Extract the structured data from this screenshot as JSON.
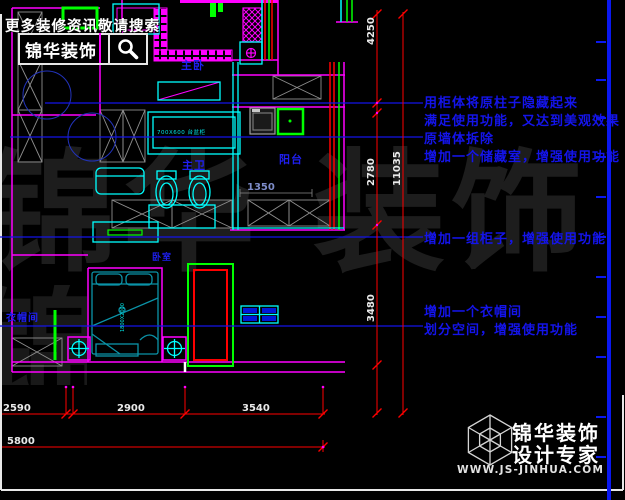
{
  "search_banner": {
    "tagline": "更多装修资讯敬请搜索",
    "brand": "锦华装饰"
  },
  "plan": {
    "room_labels": [
      {
        "text": "主卧"
      },
      {
        "text": "主卫"
      },
      {
        "text": "阳台"
      },
      {
        "text": "衣帽间"
      },
      {
        "text": "卧室"
      }
    ],
    "fixture_labels": [
      {
        "text": "700X600 台盆柜"
      },
      {
        "text": "1800X2000"
      }
    ],
    "inline_dimension": "1350"
  },
  "annotations": {
    "group1": [
      "用柜体将原柱子隐藏起来",
      "满足使用功能，又达到美观效果",
      "原墙体拆除",
      "增加一个储藏室，增强使用功能"
    ],
    "group2": [
      "增加一组柜子，增强使用功能"
    ],
    "group3": [
      "增加一个衣帽间",
      "划分空间，增强使用功能"
    ]
  },
  "dimensions": {
    "vertical": [
      "4250",
      "2780",
      "11035",
      "3480"
    ],
    "bottom_row1": [
      "2590",
      "2900",
      "3540"
    ],
    "bottom_row2": [
      "5800"
    ]
  },
  "watermark": {
    "text": "锦华 装饰"
  },
  "footer": {
    "brand": "锦华装饰",
    "tagline": "设计专家",
    "url": "WWW.JS-JINHUA.COM"
  },
  "colors": {
    "wall": "#ff00ff",
    "fixture": "#00ffff",
    "accent_green": "#00ff00",
    "dimension_red": "#ff0000",
    "annotation_blue": "#1414ea",
    "ruler_blue": "#0a18f0"
  }
}
